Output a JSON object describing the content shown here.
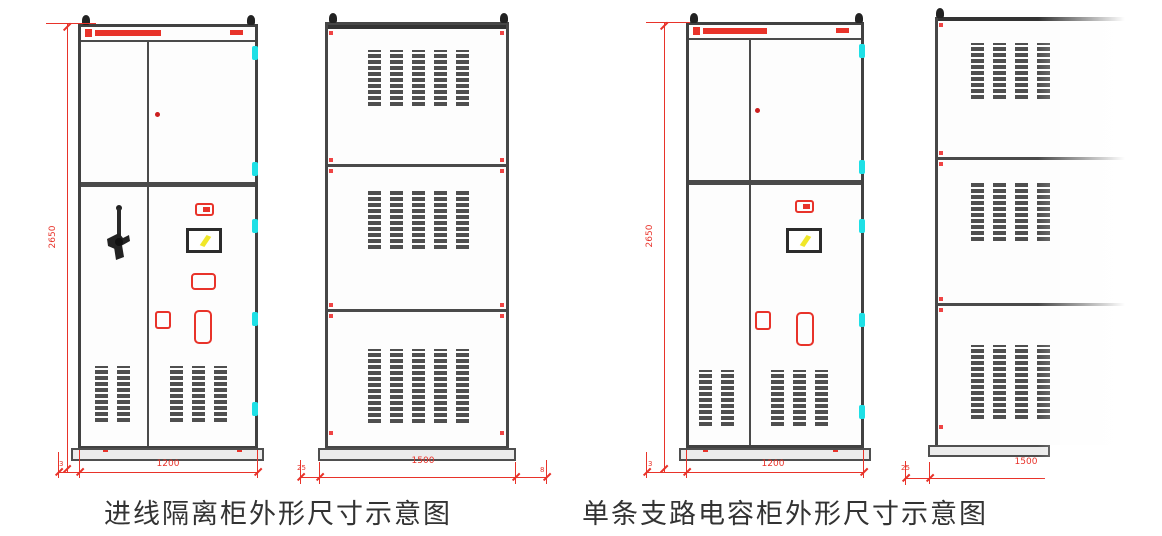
{
  "figures": [
    {
      "caption": "进线隔离柜外形尺寸示意图",
      "front_view": {
        "height_dim": "2650",
        "width_dim": "1200",
        "plinth_dim": "3"
      },
      "side_view": {
        "depth_dim": "1500",
        "left_dim": "25",
        "right_dim": "8"
      }
    },
    {
      "caption": "单条支路电容柜外形尺寸示意图",
      "front_view": {
        "height_dim": "2650",
        "width_dim": "1200",
        "plinth_dim": "3"
      },
      "side_view": {
        "depth_dim": "1500",
        "left_dim": "25"
      }
    }
  ],
  "colors": {
    "dimension_red": "#e8332a",
    "hinge_cyan": "#1ee0e6",
    "indicator_yellow": "#f0e72a",
    "frame_gray": "#414141"
  }
}
